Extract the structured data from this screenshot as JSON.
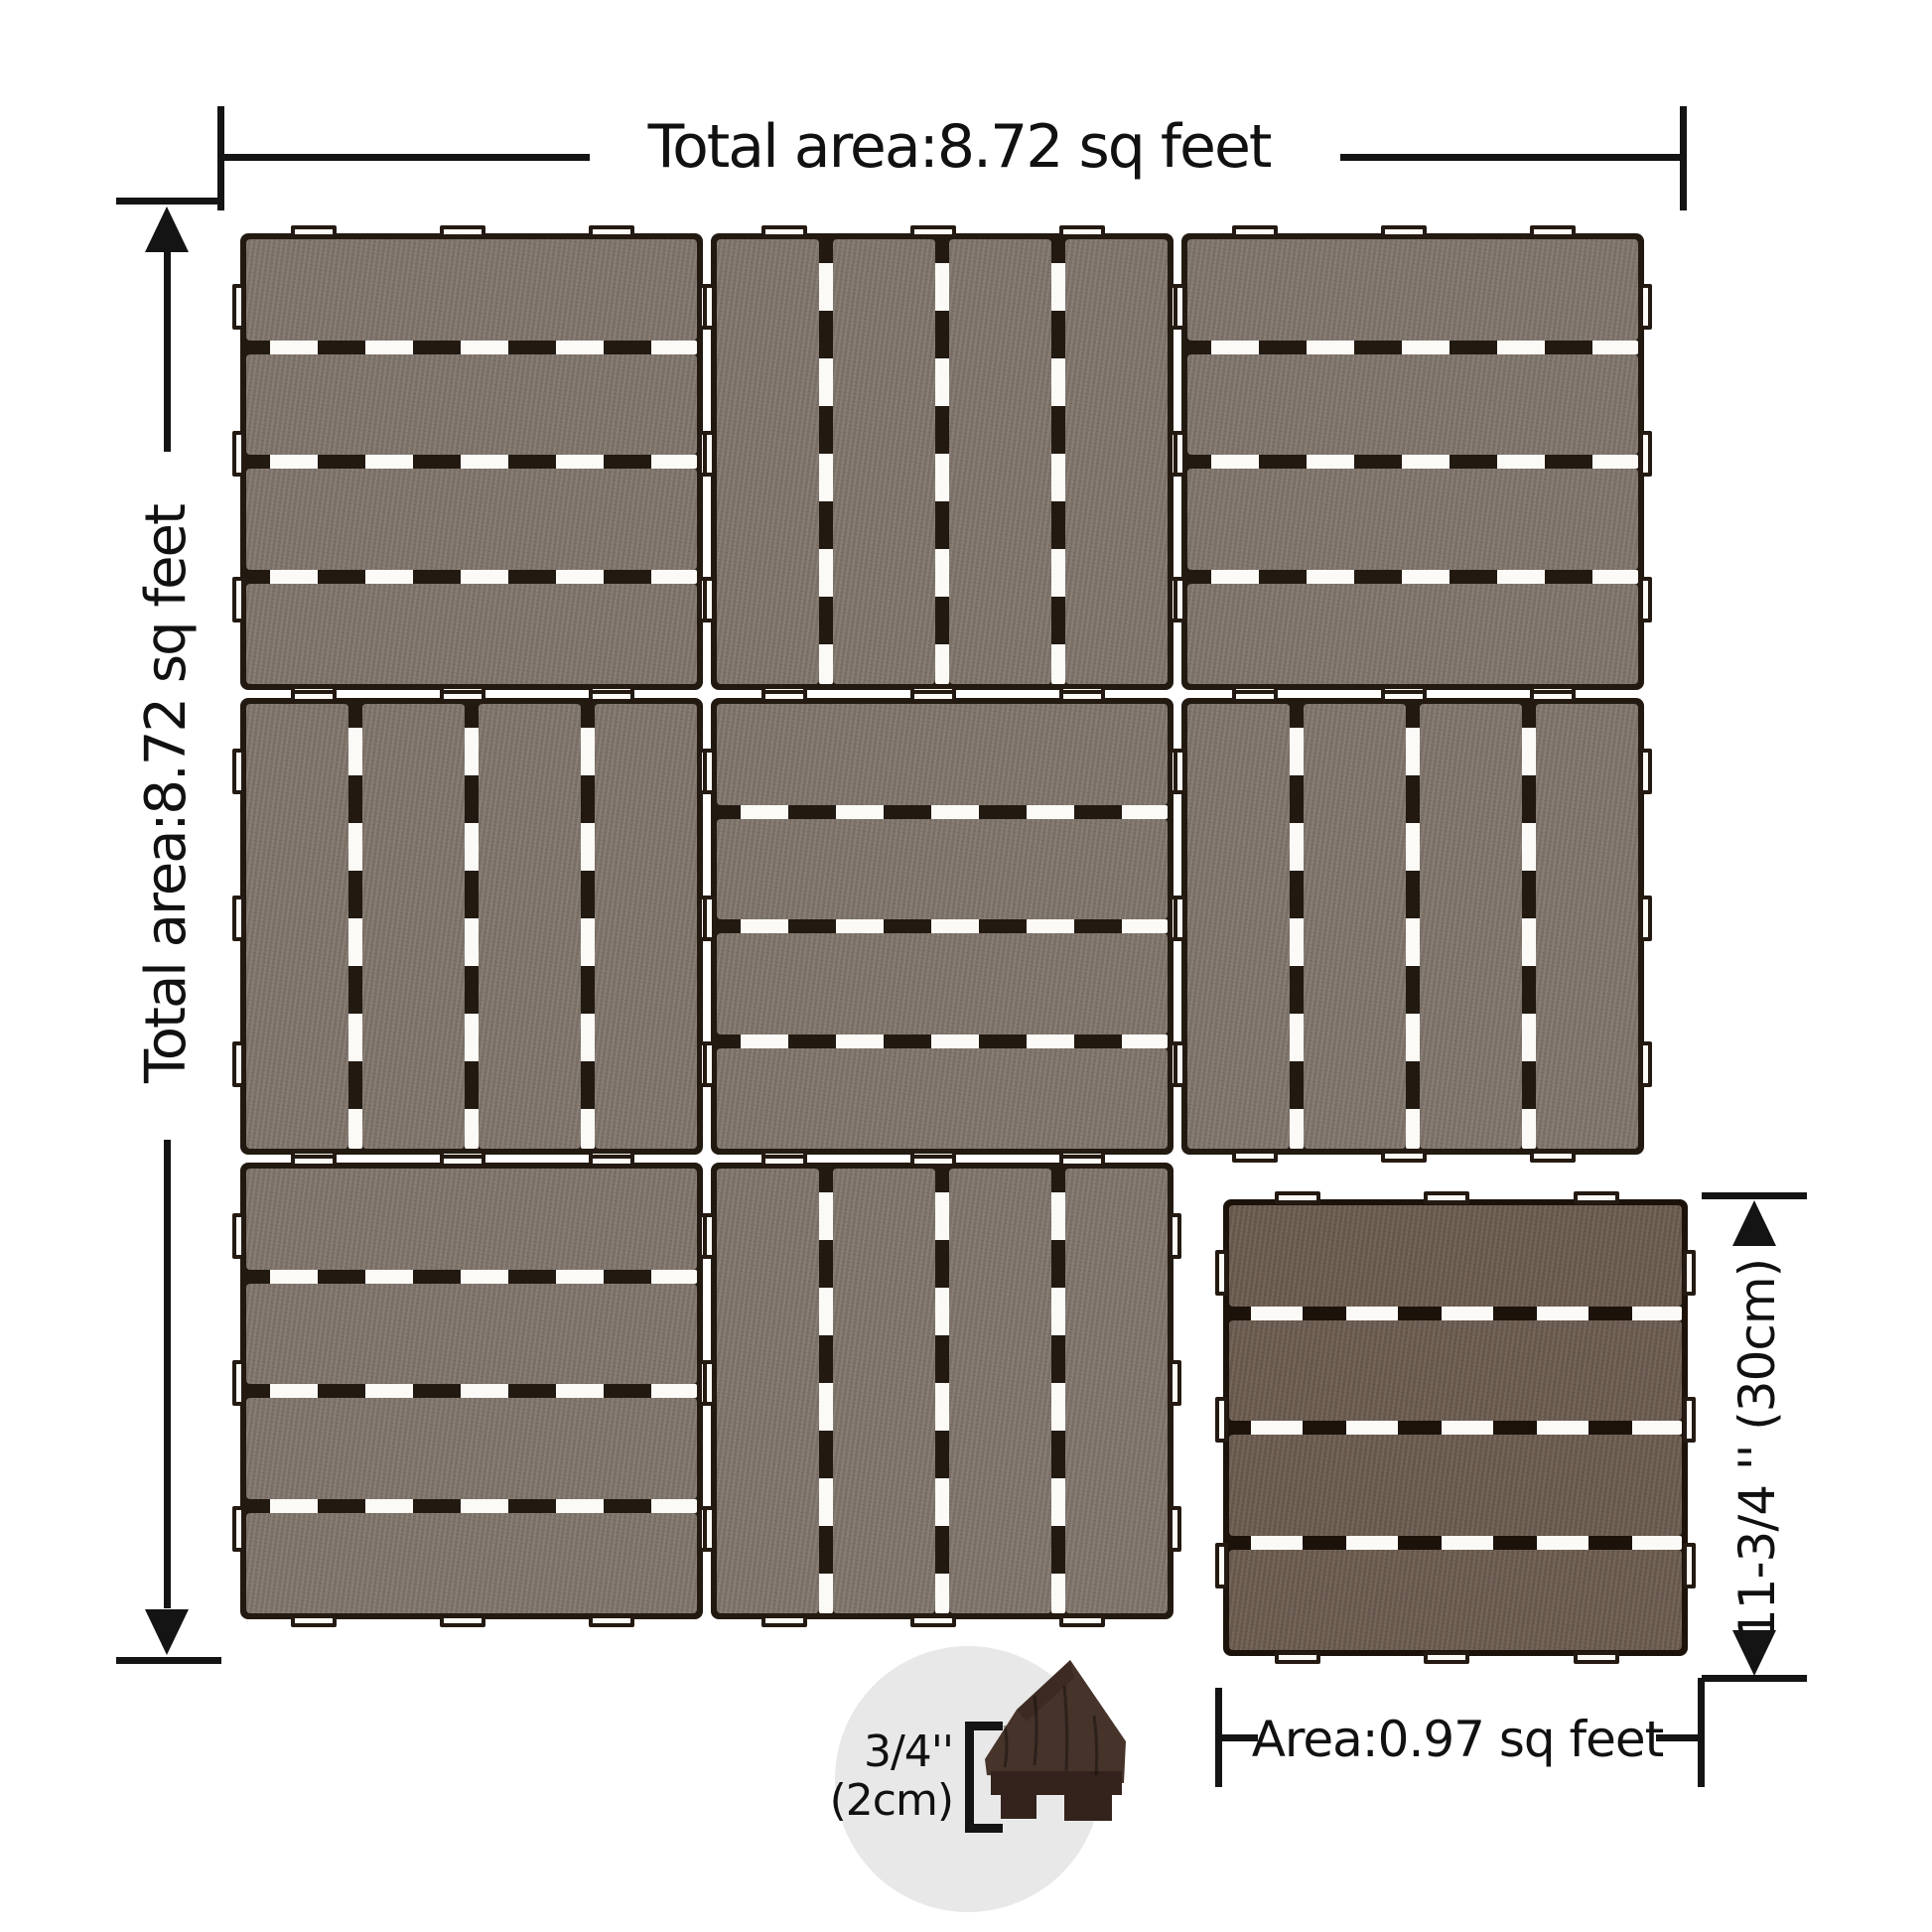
{
  "colors": {
    "line": "#141414",
    "grid_plank": "#83786e",
    "grid_backing": "#221911",
    "single_plank": "#6e5e52",
    "single_backing": "#1c120a",
    "slot_white": "#fbfaf6",
    "circle_bg": "#e8e8e8",
    "corner_piece": "#46332a",
    "corner_piece_dark": "#33231c"
  },
  "annotations": {
    "top": {
      "label": "Total area:8.72 sq feet"
    },
    "left": {
      "label": "Total area:8.72 sq feet"
    },
    "tile_height": {
      "label": "11-3/4 '' (30cm)"
    },
    "tile_area": {
      "label": "Area:0.97 sq feet"
    },
    "thickness": {
      "line1": "3/4''",
      "line2": "(2cm)"
    }
  },
  "tiles": {
    "planks_per_tile": 4,
    "grid": [
      {
        "row": 0,
        "col": 0,
        "orientation": "h"
      },
      {
        "row": 0,
        "col": 1,
        "orientation": "v"
      },
      {
        "row": 0,
        "col": 2,
        "orientation": "h"
      },
      {
        "row": 1,
        "col": 0,
        "orientation": "v"
      },
      {
        "row": 1,
        "col": 1,
        "orientation": "h"
      },
      {
        "row": 1,
        "col": 2,
        "orientation": "v"
      },
      {
        "row": 2,
        "col": 0,
        "orientation": "h"
      },
      {
        "row": 2,
        "col": 1,
        "orientation": "v"
      }
    ],
    "single": {
      "orientation": "h"
    }
  }
}
